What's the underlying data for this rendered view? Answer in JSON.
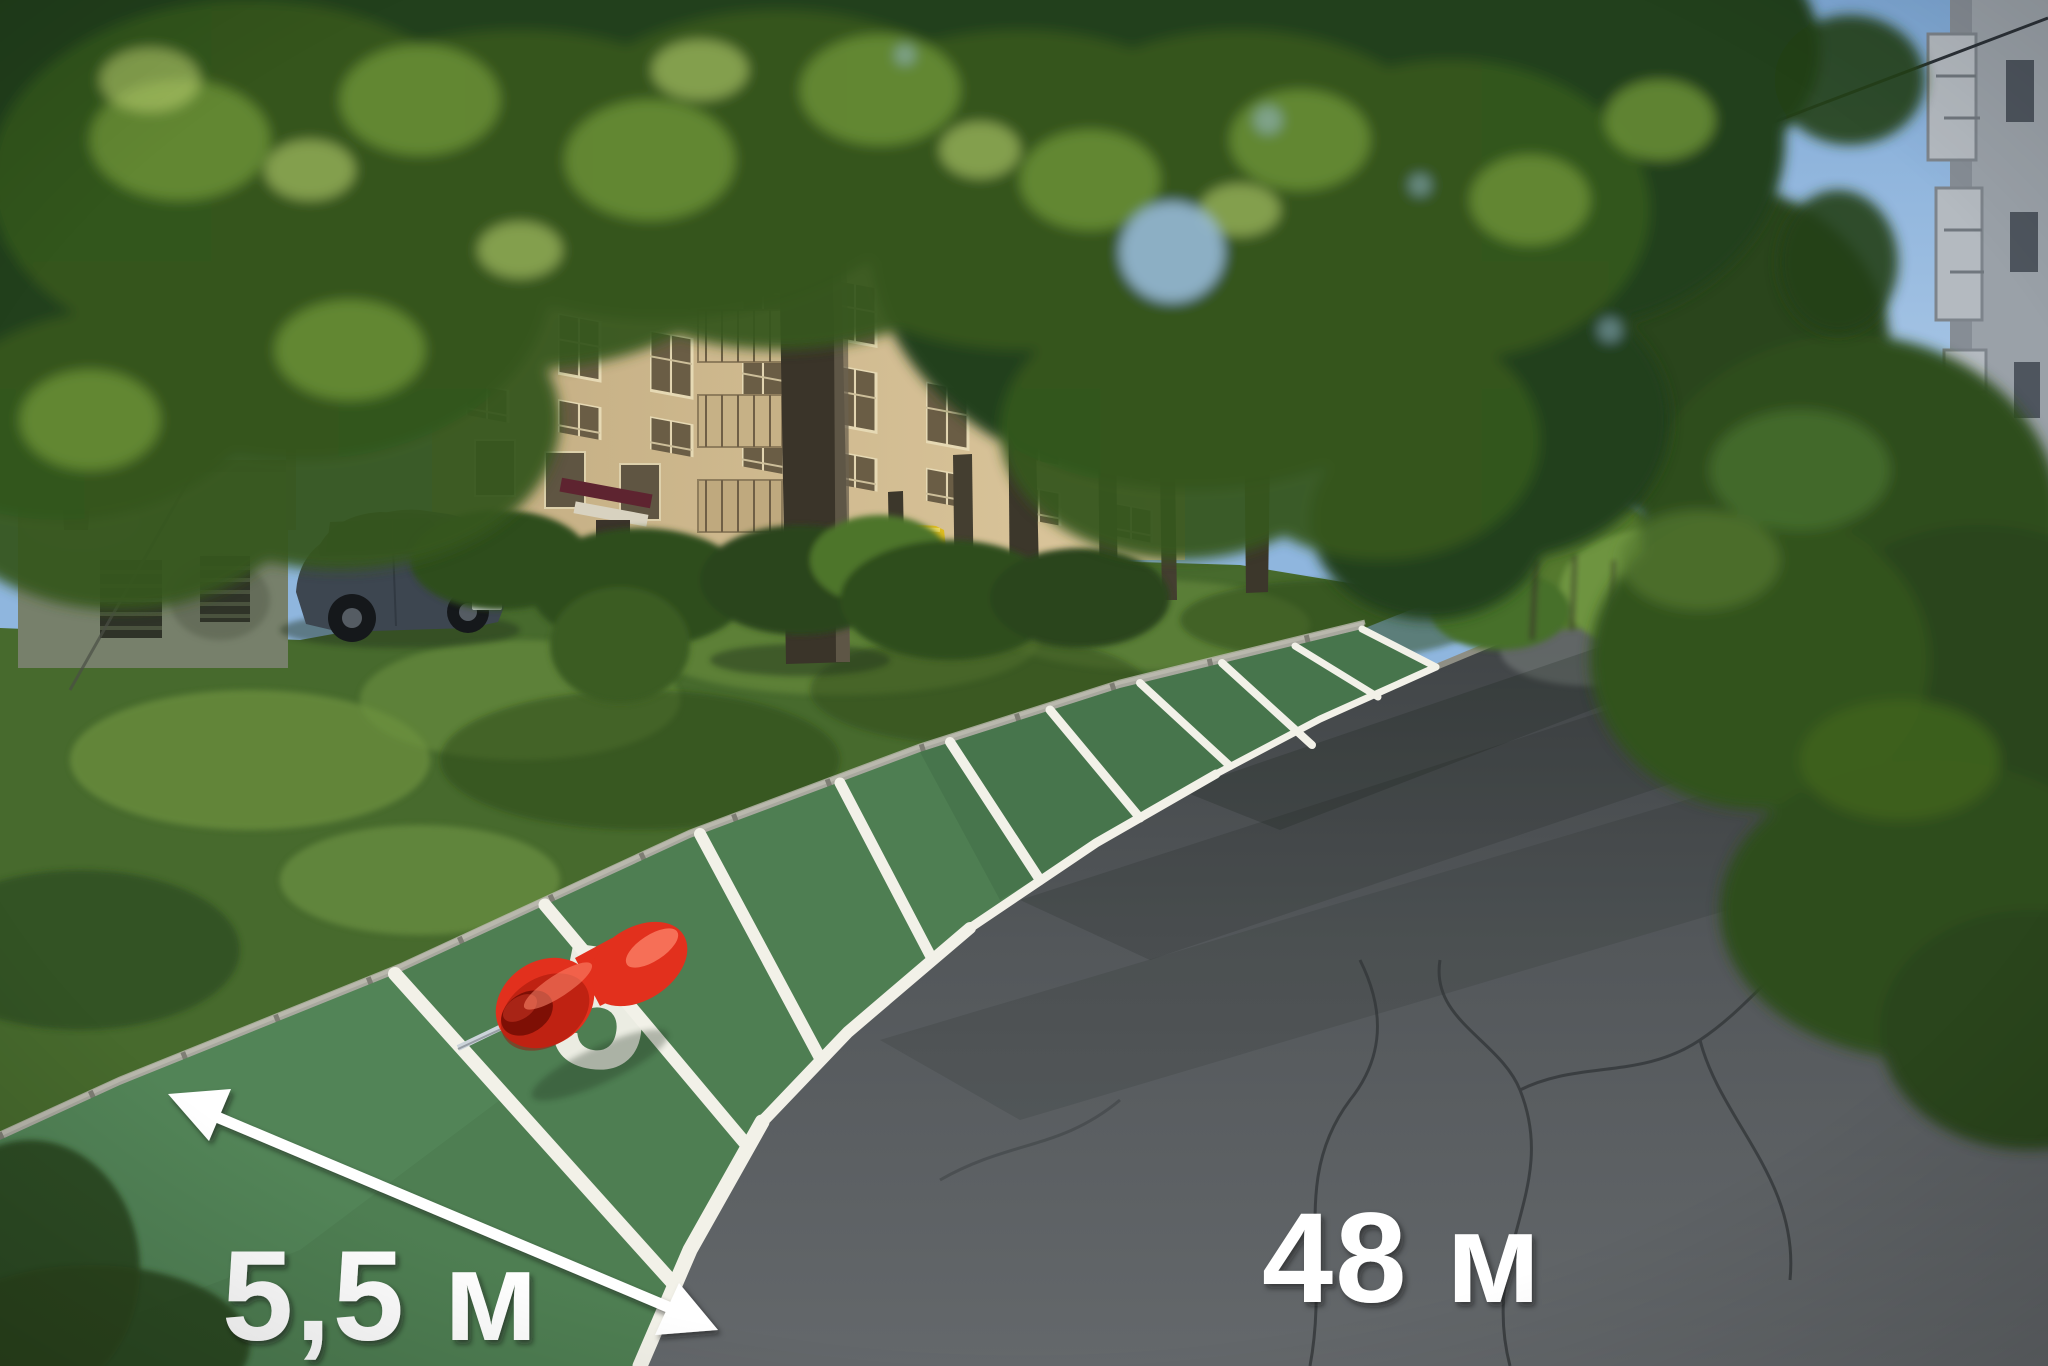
{
  "annotations": {
    "width_label": "5,5 м",
    "length_label": "48 м",
    "spot_number": "5",
    "stall_count": 10
  },
  "icons": {
    "pushpin": "pushpin-icon",
    "double_arrow": "double-arrow-icon"
  },
  "colors": {
    "sky": "#8fb6de",
    "foliage_dark": "#23401a",
    "foliage_mid": "#35571f",
    "foliage_light": "#6e9338",
    "foliage_sun": "#b9d06e",
    "grass": "#476a2d",
    "grass_light": "#6d9140",
    "grass_dark": "#2a451c",
    "building_beige": "#d6c196",
    "building_gray": "#9aa1a8",
    "window_dark": "#6a5d45",
    "shed_gray": "#77806b",
    "curb_light": "#a8a89e",
    "asphalt_light": "#636768",
    "asphalt_dark": "#3e4244",
    "dirt_brown": "#6e5b41",
    "overlay_green": "#4e7e52",
    "overlay_green_light": "#5d9061",
    "marking_white": "#f2f1e8",
    "label_white": "#ffffff",
    "pin_red": "#e2301d",
    "pin_red_dark": "#9c1408",
    "pin_highlight": "#ff8a70",
    "needle_silver": "#ccd4da",
    "trunk_dark": "#3c372b",
    "trunk_light": "#6b6250",
    "van_yellow": "#e0bc1f",
    "car_body": "#3d4650"
  }
}
